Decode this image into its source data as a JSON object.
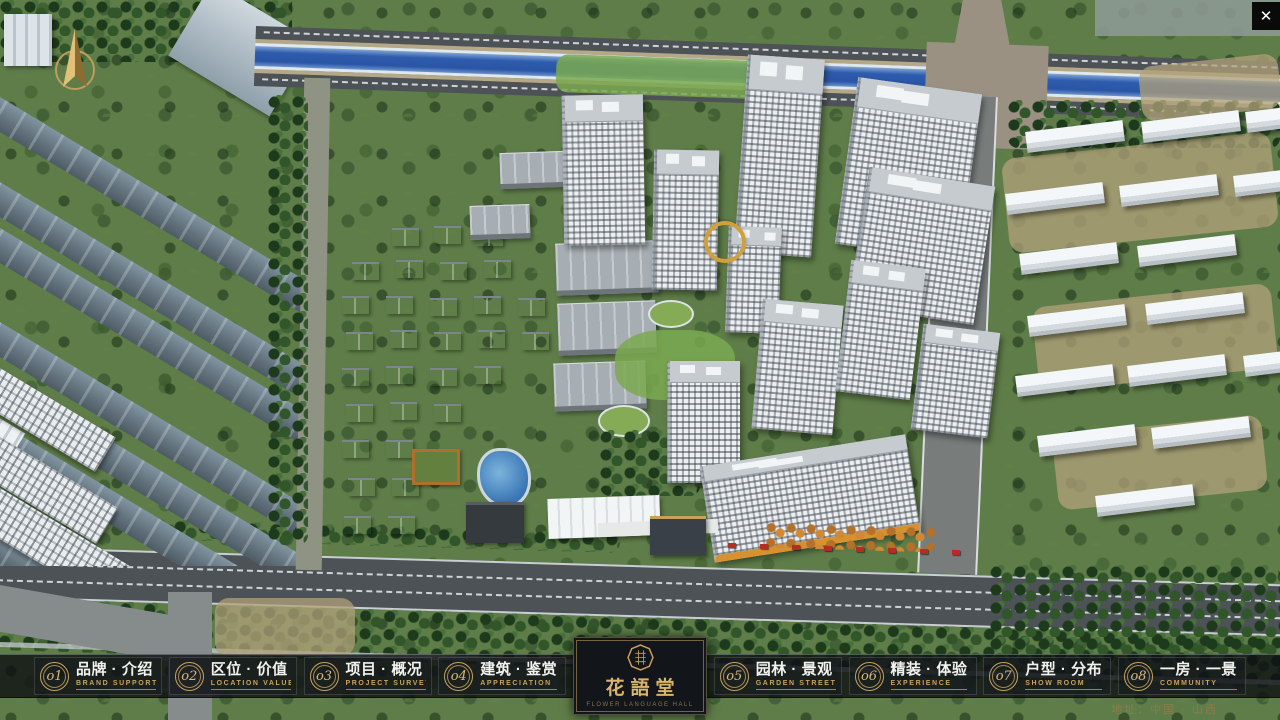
{
  "window": {
    "close_glyph": "✕"
  },
  "nav": {
    "items": [
      {
        "num": "o1",
        "title": "品牌 · 介绍",
        "subtitle": "BRAND SUPPORT"
      },
      {
        "num": "o2",
        "title": "区位 · 价值",
        "subtitle": "LOCATION VALUE"
      },
      {
        "num": "o3",
        "title": "项目 · 概况",
        "subtitle": "PROJECT SURVEY"
      },
      {
        "num": "o4",
        "title": "建筑 · 鉴赏",
        "subtitle": "APPRECIATION"
      },
      {
        "num": "o5",
        "title": "园林 · 景观",
        "subtitle": "GARDEN STREET"
      },
      {
        "num": "o6",
        "title": "精装 · 体验",
        "subtitle": "EXPERIENCE"
      },
      {
        "num": "o7",
        "title": "户型 · 分布",
        "subtitle": "SHOW ROOM"
      },
      {
        "num": "o8",
        "title": "一房 · 一景",
        "subtitle": "COMMUNITY"
      }
    ]
  },
  "logo": {
    "title": "花語堂",
    "subtitle": "FLOWER LANGUAGE HALL"
  },
  "footer": {
    "address": "地址：中国 · 山西"
  },
  "colors": {
    "gold": "#c9a25e",
    "bar_bg": "rgba(12,15,19,0.8)",
    "river": "#2e5cad",
    "map_green": "#5f7d49"
  }
}
